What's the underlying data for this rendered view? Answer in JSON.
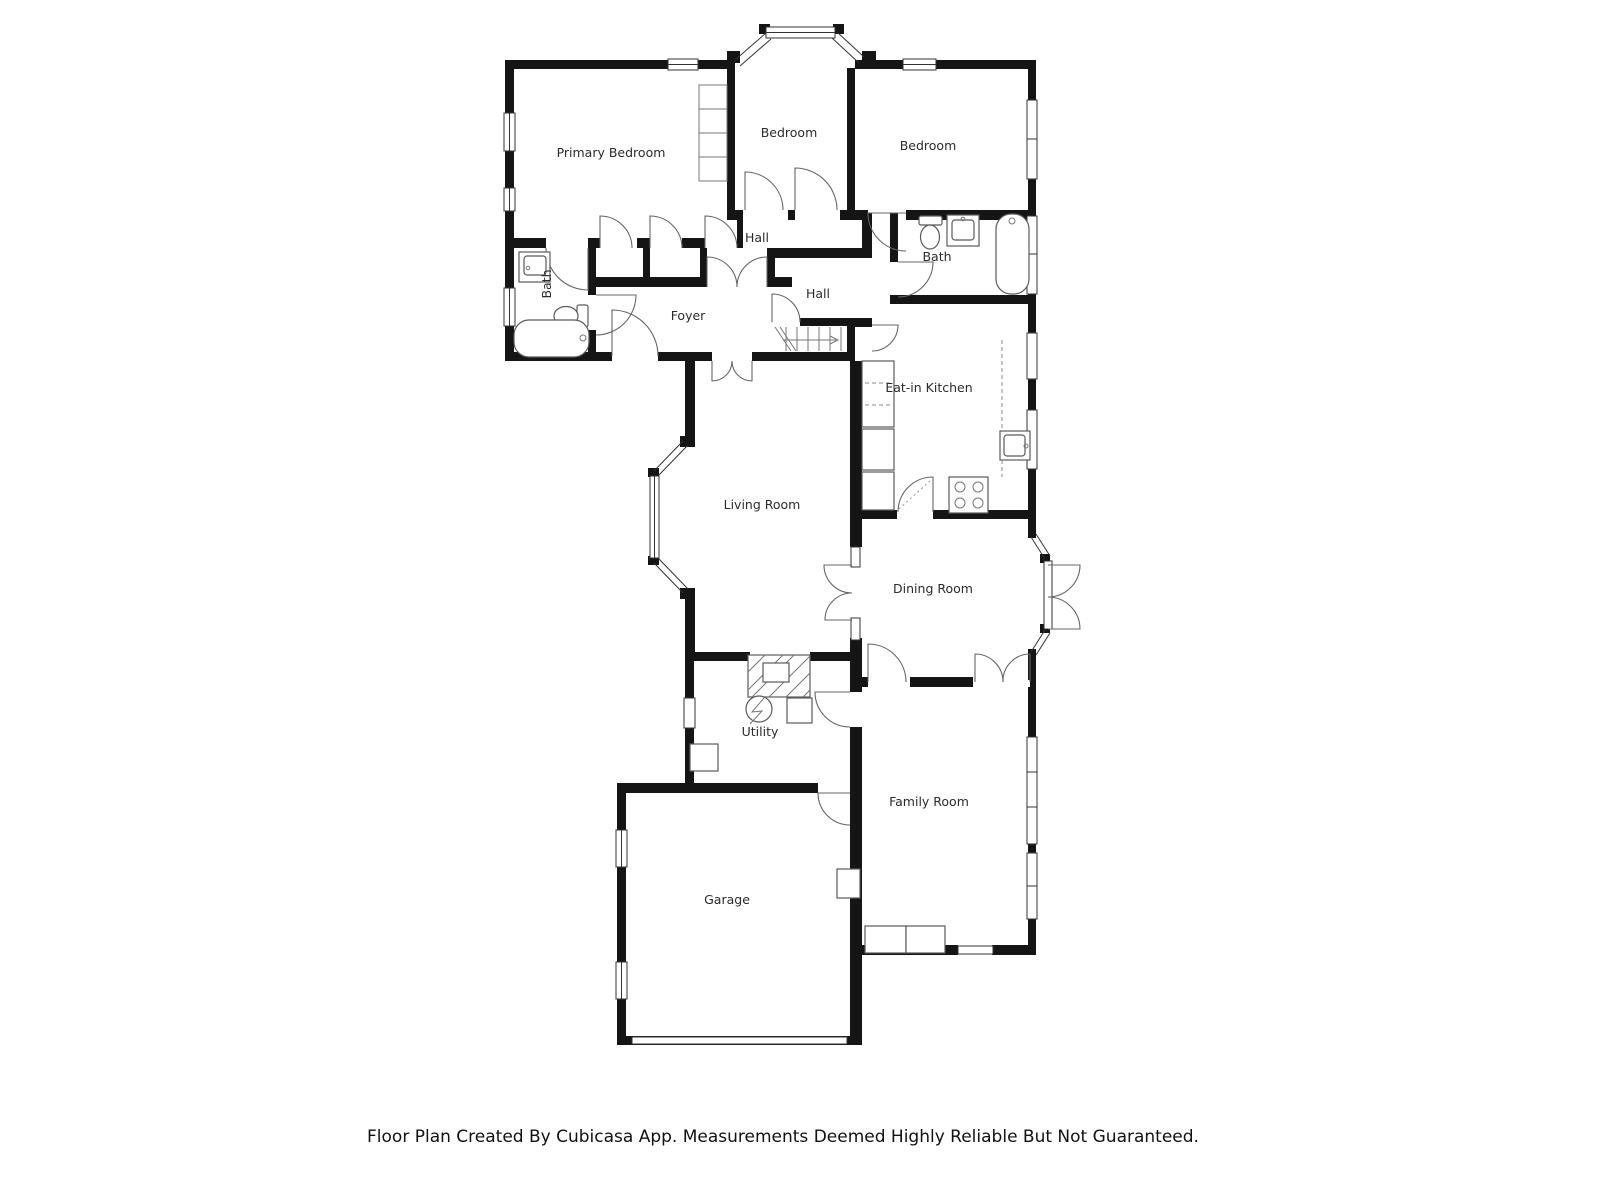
{
  "rooms": {
    "primary_bedroom": "Primary Bedroom",
    "bedroom_top": "Bedroom",
    "bedroom_right": "Bedroom",
    "bath_left": "Bath",
    "bath_right": "Bath",
    "hall_upper": "Hall",
    "hall_lower": "Hall",
    "foyer": "Foyer",
    "eat_in_kitchen": "Eat-in Kitchen",
    "living_room": "Living Room",
    "dining_room": "Dining Room",
    "utility": "Utility",
    "family_room": "Family Room",
    "garage": "Garage"
  },
  "footer": "Floor Plan Created By Cubicasa App. Measurements Deemed Highly Reliable But Not Guaranteed.",
  "colors": {
    "wall": "#151515",
    "background": "#ffffff",
    "label": "#2b2b2b"
  }
}
